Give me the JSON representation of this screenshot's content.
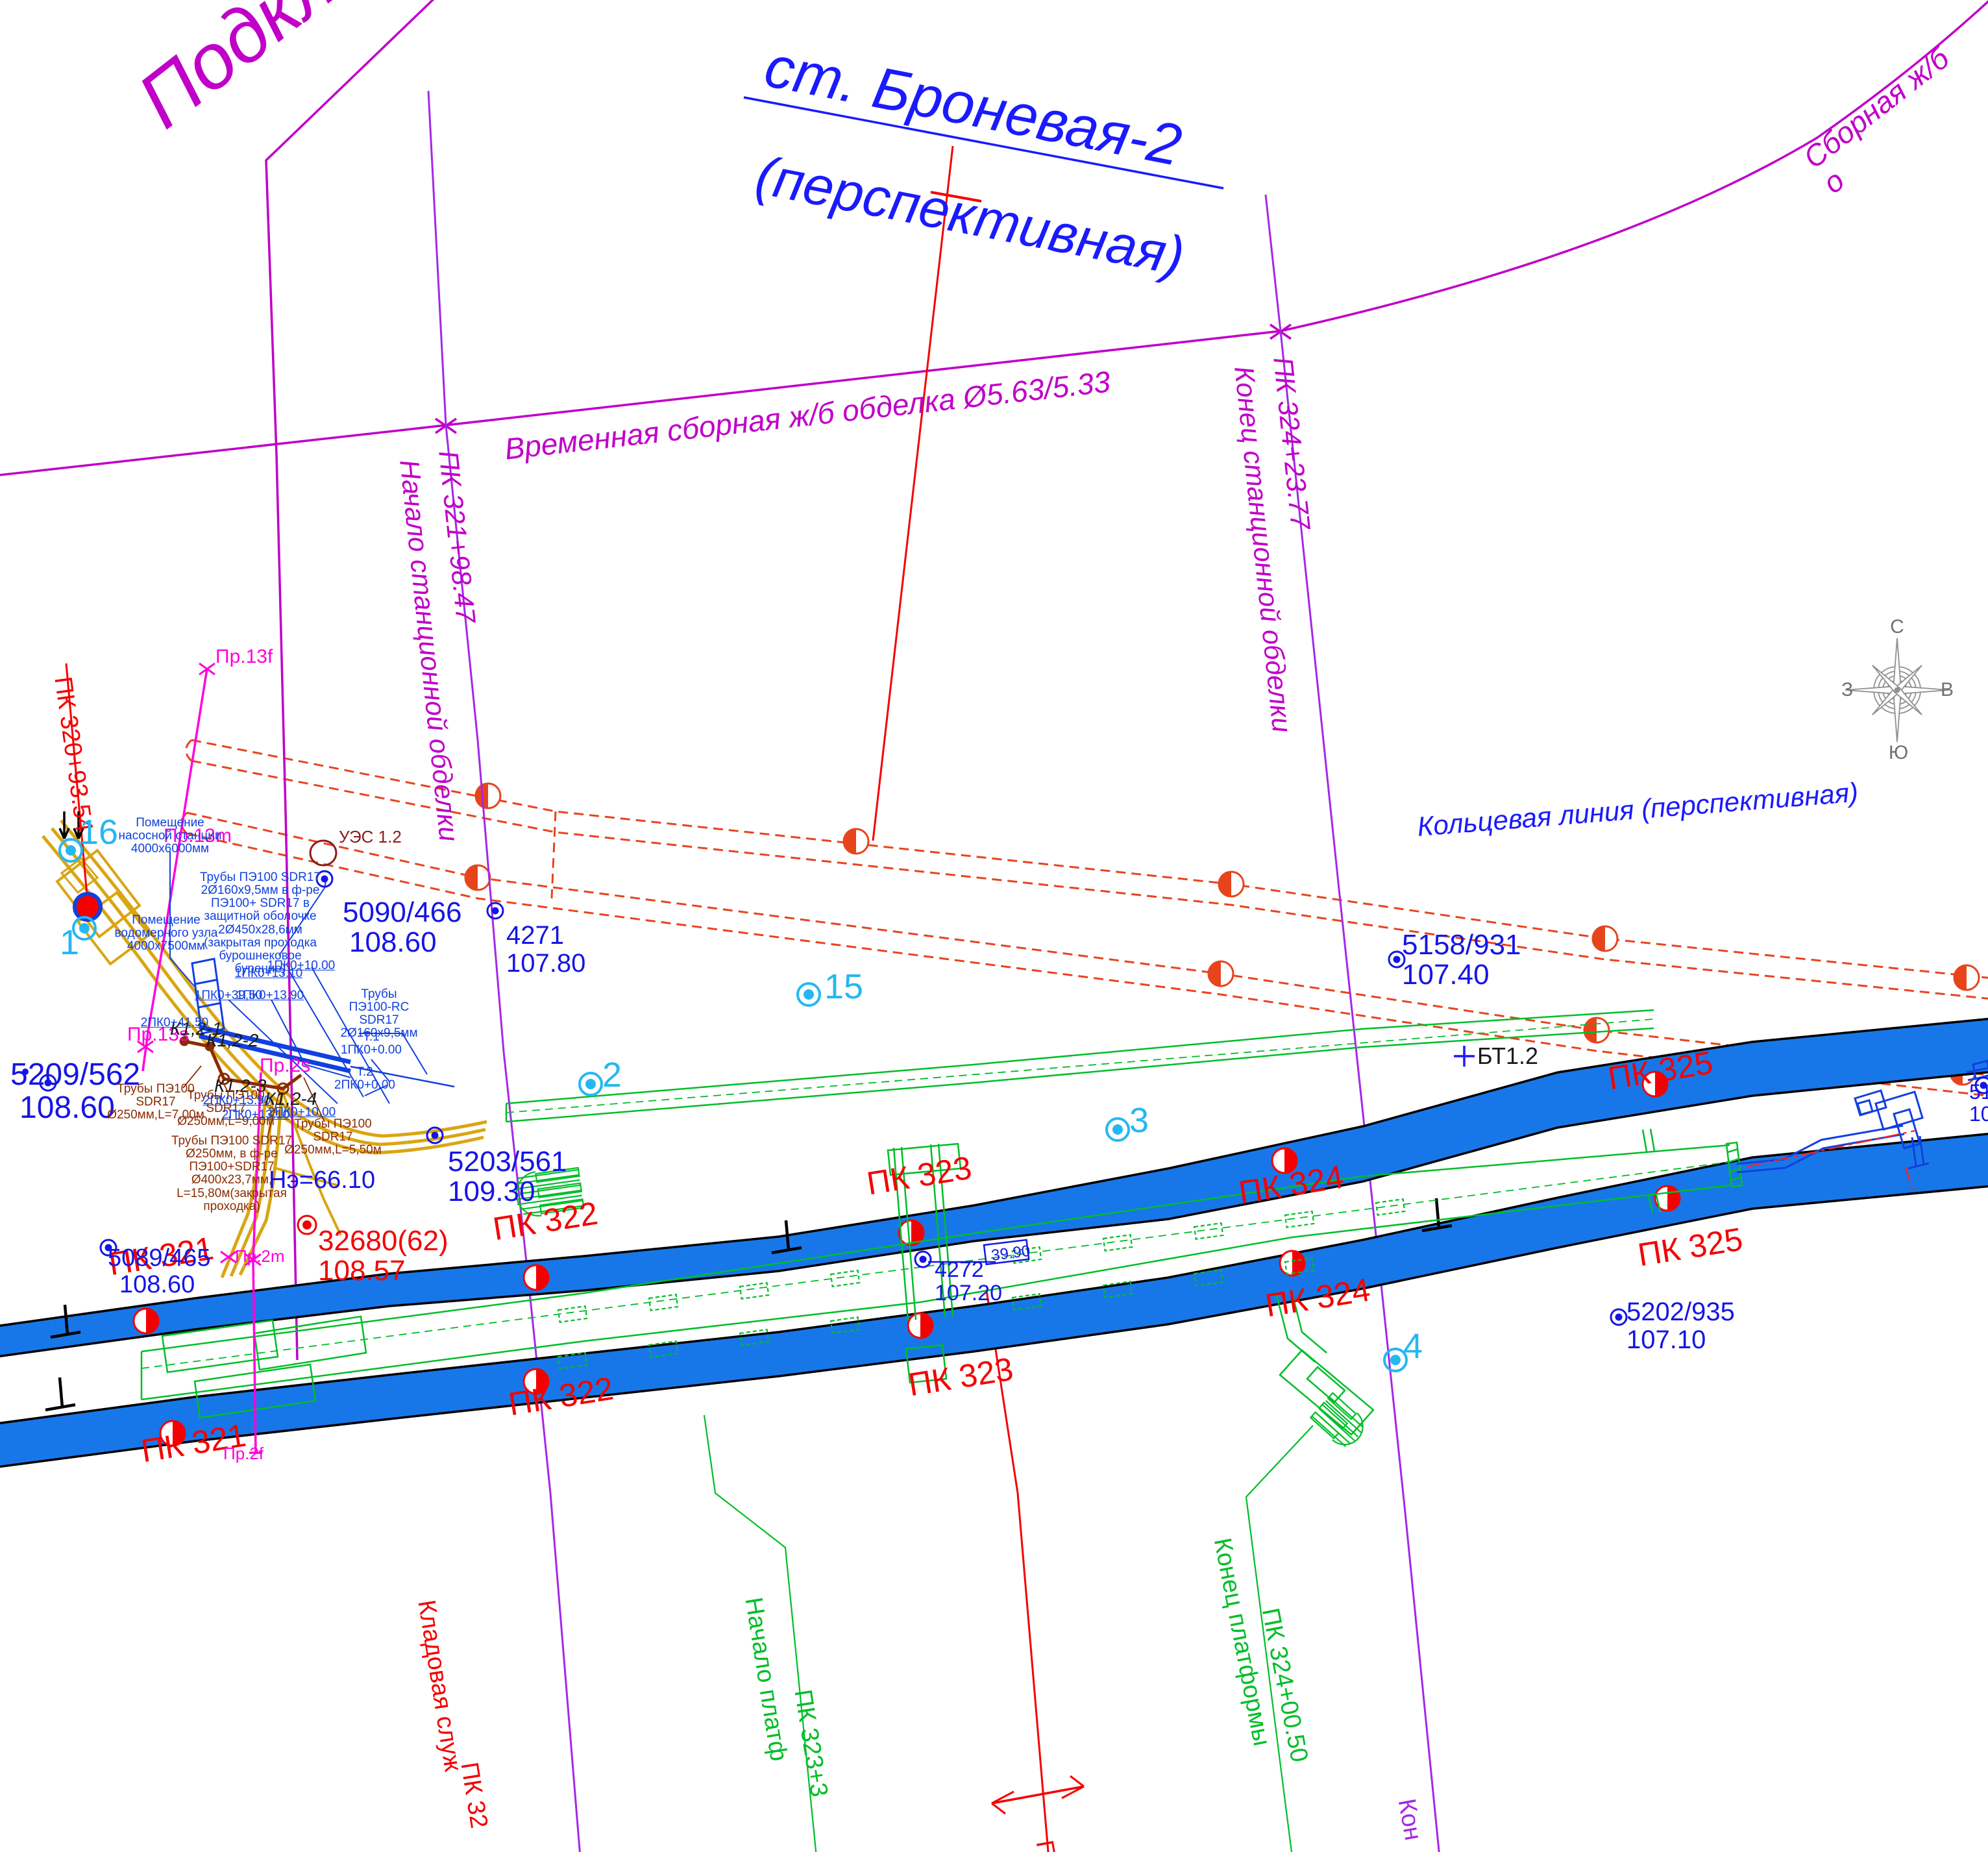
{
  "drawing": {
    "title": "ст. Броневая-2",
    "subtitle": "(перспективная)",
    "clipped_top_left": "Подклю",
    "clipped_top_right": "Сборная ж/б о",
    "clipped_right_edge_point": {
      "id": "51",
      "elev": "10"
    },
    "clipped_bottom_section": "П"
  },
  "alignment": {
    "temp_lining": "Временная сборная ж/б обделка Ø5.63/5.33",
    "lining_start_pk": "ПК 321+98.47",
    "lining_start_caption": "Начало станционной обделки",
    "lining_end_pk": "ПК 324+23.77",
    "lining_end_caption": "Конец станционной обделки",
    "face_pk": "ПК 320+93.54",
    "ring_line": "Кольцевая линия (перспективная)",
    "lining_end_clipped": "Кон"
  },
  "pickets": {
    "pk321": "ПК 321",
    "pk322": "ПК 322",
    "pk323": "ПК 323",
    "pk324": "ПК 324",
    "pk325": "ПК 325"
  },
  "platform": {
    "start": "Начало платф",
    "start_pk": "ПК 323+3",
    "end": "Конец платформы",
    "end_pk": "ПК 324+00.50",
    "storeroom": "Кладовая служ",
    "storeroom_pk": "ПК 32"
  },
  "survey_points": {
    "p5090": {
      "id": "5090/466",
      "elev": "108.60"
    },
    "p4271": {
      "id": "4271",
      "elev": "107.80"
    },
    "p5209": {
      "id": "5209/562",
      "elev": "108.60"
    },
    "p5089": {
      "id": "5089/465",
      "elev": "108.60"
    },
    "p5203": {
      "id": "5203/561",
      "elev": "109.30"
    },
    "p4272": {
      "id": "4272",
      "elev": "107.20"
    },
    "p5158": {
      "id": "5158/931",
      "elev": "107.40"
    },
    "p5202": {
      "id": "5202/935",
      "elev": "107.10"
    },
    "p32680": {
      "id": "32680(62)",
      "elev": "108.57"
    }
  },
  "annotations": {
    "dim_between_tracks": "39.90",
    "benchmark": "БТ1.2",
    "ues": "УЭС 1.2",
    "ne": "Нэ=66.10"
  },
  "numbered_points": {
    "n16": "16",
    "n1": "1",
    "n2": "2",
    "n3": "3",
    "n15": "15",
    "n4": "4"
  },
  "profile_marks": {
    "pr13f": "Пр.13f",
    "pr13m": "Пр.13m",
    "pr13s": "Пр.13s",
    "pr2s": "Пр.2s",
    "pr2m": "Пр.2m",
    "pr2f": "Пр.2f"
  },
  "sewer": {
    "k1": "К1,2-1",
    "k2": "К1,2-2",
    "k3": "К1,2-3",
    "k4": "К1,2-4",
    "note_l7": "Трубы ПЭ100\nSDR17\nØ250мм,L=7,00м",
    "note_l9": "Трубы ПЭ100\nSDR17\nØ250мм,L=9,00м",
    "note_l55": "Трубы ПЭ100\nSDR17\nØ250мм,L=5,50м",
    "note_closed": "Трубы ПЭ100 SDR17\nØ250мм, в ф-ре\nПЭ100+SDR17\nØ400х23,7мм,\nL=15,80м(закрытая\nпроходка)"
  },
  "water": {
    "room_pump": "Помещение\nнасосной станции\n4000х6000мм",
    "room_meter": "Помещение\nводомерного узла\n4000х7500мм",
    "pipes_main": "Трубы ПЭ100 SDR17\n2Ø160х9,5мм в ф-ре\nПЭ100+ SDR17 в\nзащитной оболочке\n2Ø450х28,6мм\n(закрытая проходка\nбурошнековое\nбурение)",
    "pipes_rc": "Трубы\nПЭ100-RC\nSDR17\n2Ø160х9,5мм",
    "t1": "Т.1\n1ПК0+0.00",
    "t2": "Т.2\n2ПК0+0.00",
    "callouts": [
      "1ПК0+13.10",
      "1ПК0+10.00",
      "1ПК0+39,50",
      "1ПК0+13.90",
      "2ПК0+41,50",
      "2ПК0+13.90",
      "2ПК0+13.10",
      "2ПК0+10.00"
    ]
  },
  "compass": {
    "north": "С",
    "south": "Ю",
    "west": "З",
    "east": "В"
  },
  "colors": {
    "tunnel_blue": "#1877e8",
    "survey_blue": "#1515e6",
    "utility_blue": "#1040e0",
    "green": "#00be28",
    "red": "#f50000",
    "dashed_red": "#e8441c",
    "magenta": "#c000c8",
    "bright_magenta": "#ff00dc",
    "violet": "#a428e8",
    "cyan": "#24b8f2",
    "ochre": "#d9a612",
    "brown": "#8c2b00",
    "gray": "#909090"
  }
}
